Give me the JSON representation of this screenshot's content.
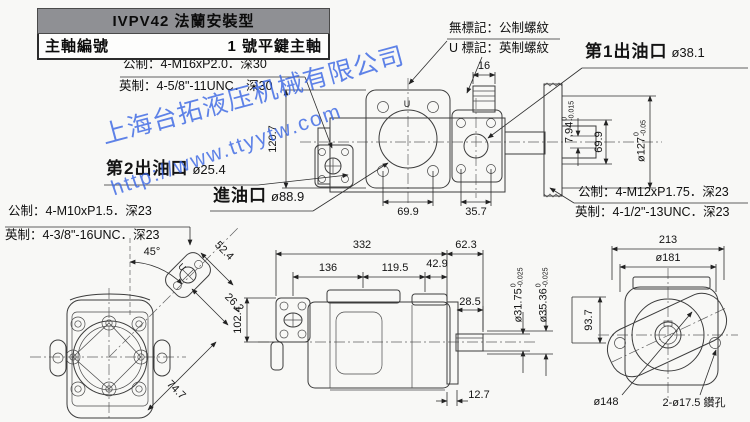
{
  "title_block": {
    "model_header": "IVPV42 法蘭安裝型",
    "spindle_label": "主軸編號",
    "spindle_value": "1 號平鍵主軸"
  },
  "watermark": {
    "line1": "上海台拓液压机械有限公司",
    "line2": "http://www.ttyytw.com",
    "color": "#3764e4"
  },
  "notes": {
    "m16_metric": "公制：4-M16xP2.0．深30",
    "m16_imperial": "英制：4-5/8\"-11UNC．深30",
    "thread_no_mark": "無標記：公制螺紋",
    "thread_u_mark": "U 標記：英制螺紋",
    "m12_metric": "公制：4-M12xP1.75．深23",
    "m12_imperial": "英制：4-1/2\"-13UNC．深23",
    "m10_metric": "公制：4-M10xP1.5．深23",
    "m10_imperial": "英制：4-3/8\"-16UNC．深23"
  },
  "ports": {
    "outlet1_label": "第1出油口",
    "outlet1_size": "ø38.1",
    "outlet2_label": "第2出油口",
    "outlet2_size": "ø25.4",
    "inlet_label": "進油口",
    "inlet_size": "ø88.9"
  },
  "dims": {
    "d16": "16",
    "d120_7": "120.7",
    "d69_9_ports": "69.9",
    "d35_7": "35.7",
    "d7_94": "7.94",
    "d7_94_tol_top": "0",
    "d7_94_tol_bot": "-0.015",
    "d69_9_shaft": "69.9",
    "d127": "ø127",
    "d127_tol_top": "0",
    "d127_tol_bot": "-0.05",
    "d45": "45°",
    "d52_4": "52.4",
    "d26_2": "26.2",
    "d74_7": "74.7",
    "d102_4": "102.4",
    "d332": "332",
    "d62_3": "62.3",
    "d136": "136",
    "d119_5": "119.5",
    "d42_9": "42.9",
    "d28_5": "28.5",
    "d12_7": "12.7",
    "d31_75": "ø31.75",
    "d31_75_tol_top": "0",
    "d31_75_tol_bot": "-0.025",
    "d35_36": "ø35.36",
    "d35_36_tol_top": "0",
    "d35_36_tol_bot": "-0.025",
    "d93_7": "93.7",
    "d213": "213",
    "d181": "ø181",
    "d148": "ø148",
    "drill_note": "2-ø17.5 鑽孔",
    "u_mark": "U"
  }
}
